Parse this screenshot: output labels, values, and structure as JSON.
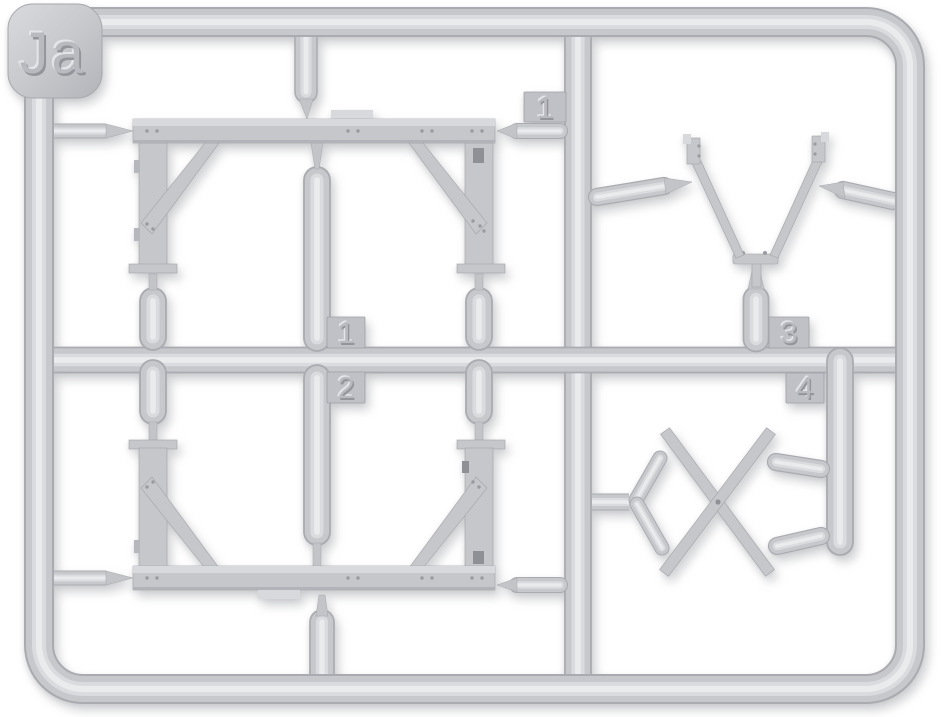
{
  "image": {
    "description": "Light-grey injection-moulded model kit sprue (runner frame) holding four parts: two ladder-frame crossmembers, a V-shaped tow bar and an X-shaped scissor brace",
    "background_color": "#ffffff"
  },
  "sprue": {
    "id_label": "Ja",
    "part_tags": {
      "tag_1_top": "1",
      "tag_1_mid": "1",
      "tag_2": "2",
      "tag_3": "3",
      "tag_4": "4"
    },
    "colors": {
      "plastic_base": "#c7c8cc",
      "plastic_shadow": "#aaabb0",
      "plastic_light": "#dadbde",
      "plastic_highlight": "#eaebed",
      "flat_part": "#c6c7cb",
      "tag_plate": "#c0c1c6",
      "emboss_main": "#b9bac0",
      "emboss_light": "#e4e5e8",
      "emboss_dark": "#94959b",
      "slot_dark": "#8f9095",
      "background": "#ffffff"
    }
  }
}
